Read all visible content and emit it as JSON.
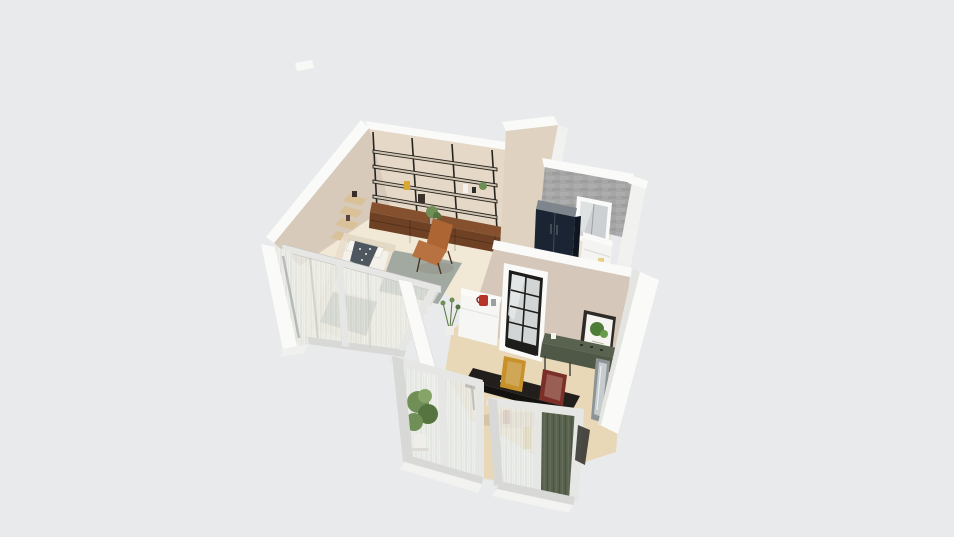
{
  "app": {
    "view": "3d-floorplan-isometric-render",
    "description": "dollhouse cutaway render of a small apartment on a plain canvas"
  },
  "palette": {
    "bg": "#e9eaeb",
    "wall-white": "#fafaf9",
    "wall-white-dim": "#f1f1f0",
    "wall-beige-back": "#e5d8c7",
    "wall-beige-left": "#d8cabb",
    "wall-greige": "#d5c8ba",
    "wall-gray-concrete": "#a0a0a0",
    "wall-gray-concrete-light": "#bcbcbc",
    "floor-cream": "#f1e8d5",
    "floor-bedroom": "#f3ecdc",
    "floor-tan": "#e9d8b8",
    "spine-beige": "#e0d2c1",
    "shelf-black": "#26231f",
    "shelf-board": "#cfc4b2",
    "sideboard-top": "#84502e",
    "sideboard-front": "#6e4124",
    "corner-shelf": "#d9c29a",
    "leather": "#ad6534",
    "leather-dark": "#8a4f27",
    "bed-cream": "#e9dfcc",
    "duvet-white": "#f3f1e9",
    "blanket-sage": "#a9b1a3",
    "cushion-dark": "#4e565f",
    "rug-gray": "#99a29a",
    "navy-wardrobe": "#1b2432",
    "navy-wardrobe-side": "#10161f",
    "wardrobe-top": "#7e858c",
    "glass-gray": "#cdd0d2",
    "door-black": "#1d1d1b",
    "door-glass": "#d2d5d6",
    "frame-white": "#e6e6e4",
    "frame-white-dim": "#d8d8d6",
    "desk-green": "#4f5747",
    "desk-green-top": "#59614f",
    "curtain-green": "#5a6351",
    "table-dark": "#211e1b",
    "frame-mustard": "#c8922b",
    "frame-maroon": "#7c2f28",
    "art-green": "#4e7d3a",
    "kettle-red": "#b23527",
    "plant-green": "#6f8f56",
    "plant-green-dark": "#55743f",
    "pot-white": "#efeee9",
    "shadow": "rgba(110,100,85,0.16)"
  },
  "scene": {
    "rooms": [
      {
        "name": "studio-living-room",
        "furniture": [
          "wall-shelving-unit",
          "walnut-sideboard",
          "leather-lounge-chair",
          "corner-wall-shelves",
          "gray-rug",
          "shelf-decor-plant"
        ]
      },
      {
        "name": "glass-bedroom-enclosure",
        "furniture": [
          "bed",
          "sheer-curtain-partitions"
        ]
      },
      {
        "name": "utility-bathroom",
        "furniture": [
          "navy-wardrobe",
          "white-appliance-cabinet",
          "white-interior-window"
        ]
      },
      {
        "name": "kitchen-dining-room",
        "furniture": [
          "black-frame-glass-door",
          "white-kitchen-counter",
          "red-kettle",
          "green-console-desk",
          "botanical-wall-art",
          "leaning-mirror",
          "dark-dining-table",
          "mustard-picture-frame",
          "maroon-picture-frame",
          "tall-potted-plant",
          "green-curtain-window-wall"
        ]
      }
    ]
  }
}
